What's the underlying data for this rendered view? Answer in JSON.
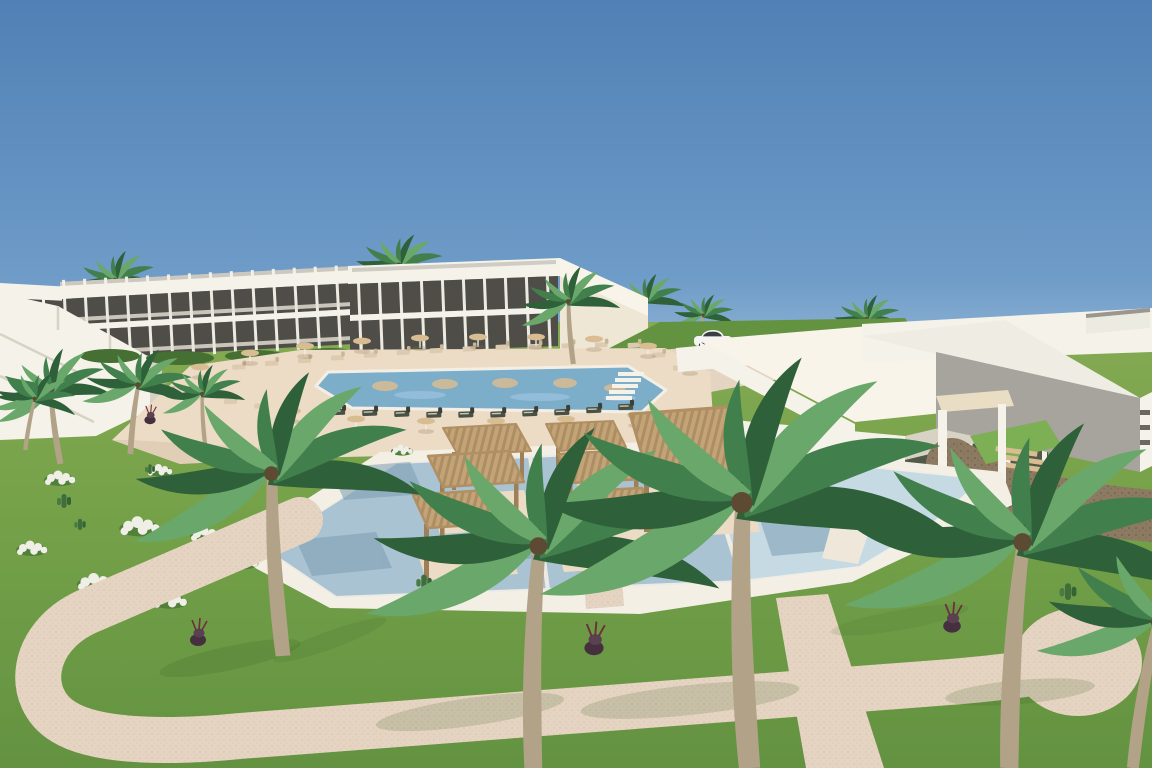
{
  "scene": {
    "type": "3d-architectural-render",
    "subject": "aerial rendering of a resort complex: two-storey hotel blocks, main swimming pool with sun loungers and parasols, restaurant pavilion, leisure pool with wooden pergolas and wicker seating, palm trees, lawns with white flower beds and winding sand-coloured walkways under a clear blue sky",
    "elements": [
      "sky",
      "hotel-block-left",
      "hotel-block-center",
      "corner-building",
      "restaurant-pavilion",
      "service-building-right",
      "main-pool",
      "sun-loungers",
      "parasols",
      "leisure-pool",
      "pergolas",
      "palm-trees",
      "flower-beds",
      "walkways",
      "dirt-path",
      "white-car",
      "terrace-seating"
    ]
  },
  "colors": {
    "sky_top": "#5080b5",
    "sky_mid": "#6f9cc8",
    "sky_horizon": "#a6c4de",
    "grass_far": "#85aa53",
    "grass": "#74a148",
    "grass_dark": "#639241",
    "grass_bright": "#7db054",
    "shadow_green": "#3c6527",
    "path": "#e6d4c2",
    "path_speck": "#d2bda9",
    "deck": "#ecdcc6",
    "deck_shade": "#d9c5ad",
    "dirt": "#8c7a62",
    "dirt_dark": "#71604b",
    "pool_main": "#7cadc9",
    "pool_main_light": "#aacced",
    "pool_front": "#a9c3d3",
    "pool_front_light": "#c6dae4",
    "pool_shadow": "#7b9cb0",
    "water_edge": "#f4efe5",
    "building_white": "#f5f2ea",
    "building_bright": "#f8f4ea",
    "building_cream": "#efe7d6",
    "building_shade": "#d8d2c4",
    "roof_gray": "#a9a59c",
    "wall_gray": "#a7a49e",
    "opening_dark": "#4f4d48",
    "glass_dark": "#3f423f",
    "wood": "#c4a377",
    "wood_dark": "#9d8059",
    "wood_light": "#d8bd93",
    "trunk": "#b2a388",
    "palm_green": "#41804d",
    "palm_dark": "#2e6139",
    "palm_light": "#69a86a",
    "flower_white": "#f0efe7",
    "planter_purple": "#46303f",
    "car_white": "#f4f4f4",
    "lounger": "#dccbb0",
    "lounger_dark": "#4b5045",
    "umbrella": "#d8bd92",
    "furniture": "#7b6347"
  }
}
